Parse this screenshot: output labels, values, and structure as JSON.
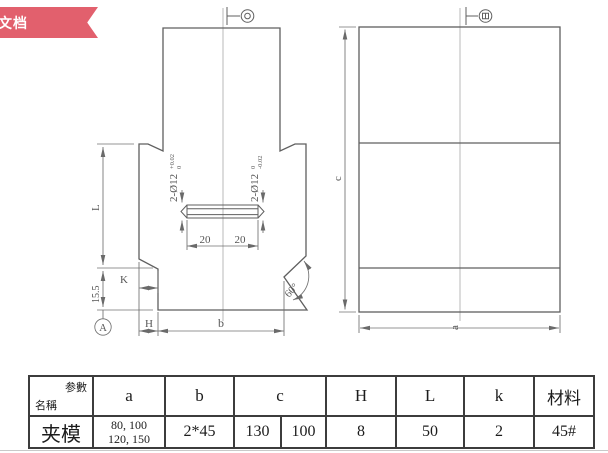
{
  "badge": {
    "label": "文档"
  },
  "colors": {
    "badge": "#e2606d",
    "drawing_line": "#5f5f5f",
    "table_border": "#3c3c3c"
  },
  "drawing": {
    "left_view": {
      "hole_dim_left": {
        "main": "2-Ø12",
        "tol_top": "+0.02",
        "tol_bottom": "0"
      },
      "hole_dim_right": {
        "main": "2-Ø12",
        "tol_top": "0",
        "tol_bottom": "-0.02"
      },
      "slot_dim_left": "20",
      "slot_dim_right": "20",
      "dim_L": "L",
      "dim_15_5": "15.5",
      "dim_K": "K",
      "dim_H": "H",
      "dim_b": "b",
      "angle": "60°",
      "datum": "A"
    },
    "right_view": {
      "dim_c": "c",
      "dim_a": "a"
    }
  },
  "table": {
    "corner_top": "参數",
    "corner_bottom": "名稱",
    "headers": [
      "a",
      "b",
      "c",
      "H",
      "L",
      "k",
      "材料"
    ],
    "row": {
      "name": "夹模",
      "a_line1": "80, 100",
      "a_line2": "120, 150",
      "b": "2*45",
      "c1": "130",
      "c2": "100",
      "H": "8",
      "L": "50",
      "k": "2",
      "material": "45#"
    }
  }
}
